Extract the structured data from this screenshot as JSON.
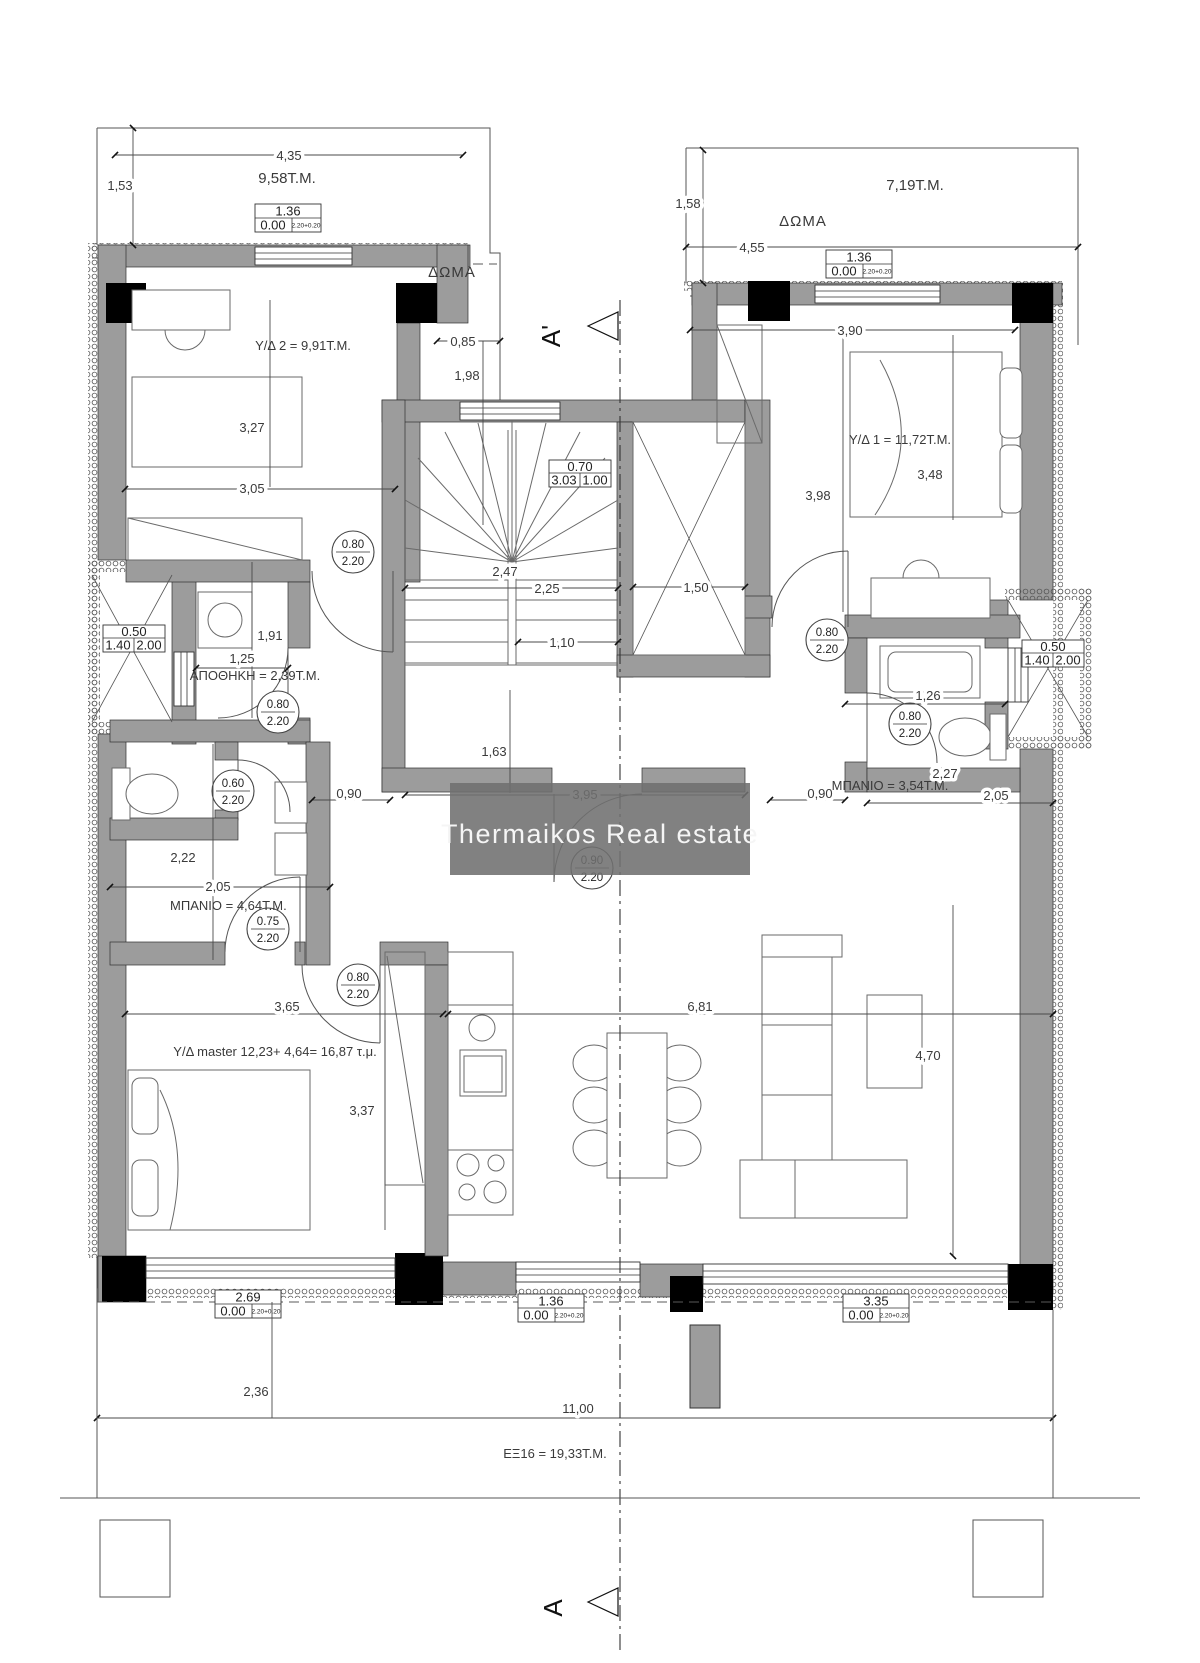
{
  "watermark": {
    "text": "Thermaikos Real estate",
    "bg_color": "#6f6f6f",
    "text_color": "#f5f5f5"
  },
  "rooms": {
    "bed2": "Υ/Δ 2 = 9,91Τ.Μ.",
    "bed1": "Υ/Δ 1 = 11,72Τ.Μ.",
    "master": "Υ/Δ master 12,23+ 4,64= 16,87 τ.μ.",
    "storage": "ΑΠΟΘΗΚΗ = 2,39Τ.Μ.",
    "bath_left": "ΜΠΑΝΙΟ = 4,64Τ.Μ.",
    "bath_right": "ΜΠΑΝΙΟ = 3,54Τ.Μ.",
    "balcony": "ΕΞ16 = 19,33Τ.Μ.",
    "roof_left": "ΔΩΜΑ",
    "roof_right": "ΔΩΜΑ",
    "roof_area_left": "9,58T.M.",
    "roof_area_right": "7,19T.M."
  },
  "sections": {
    "top": "A'",
    "bottom": "A"
  },
  "dims": {
    "d435": "4,35",
    "d153": "1,53",
    "d158": "1,58",
    "d455": "4,55",
    "d390": "3,90",
    "d327": "3,27",
    "d305": "3,05",
    "d085": "0,85",
    "d198": "1,98",
    "d247": "2,47",
    "d225": "2,25",
    "d110": "1,10",
    "d150": "1,50",
    "d191": "1,91",
    "d125": "1,25",
    "d163": "1,63",
    "d395": "3,95",
    "d090l": "0,90",
    "d090r": "0,90",
    "d126": "1,26",
    "d227": "2,27",
    "d205r": "2,05",
    "d222": "2,22",
    "d205l": "2,05",
    "d365": "3,65",
    "d337": "3,37",
    "d681": "6,81",
    "d470": "4,70",
    "d398": "3,98",
    "d348": "3,48",
    "d236": "2,36",
    "d1100": "11,00"
  },
  "door_tags": {
    "c1": {
      "w": "0.80",
      "h": "2.20"
    },
    "c2": {
      "w": "0.80",
      "h": "2.20"
    },
    "c3": {
      "w": "0.60",
      "h": "2.20"
    },
    "c4": {
      "w": "0.75",
      "h": "2.20"
    },
    "c5": {
      "w": "0.80",
      "h": "2.20"
    },
    "c6": {
      "w": "0.80",
      "h": "2.20"
    },
    "c7": {
      "w": "0.80",
      "h": "2.20"
    },
    "c8": {
      "w": "0.90",
      "h": "2.20"
    }
  },
  "window_tags": {
    "t1": {
      "a": "1.36",
      "b": "0.00",
      "c": "2.20+0.20"
    },
    "t2": {
      "a": "1.36",
      "b": "0.00",
      "c": "2.20+0.20"
    },
    "t3": {
      "a": "0.70",
      "b": "3.03",
      "c": "1.00"
    },
    "t4": {
      "a": "0.50",
      "b": "1.40",
      "c": "2.00"
    },
    "t5": {
      "a": "0.50",
      "b": "1.40",
      "c": "2.00"
    },
    "t6": {
      "a": "2.69",
      "b": "0.00",
      "c": "2.20+0.20"
    },
    "t7": {
      "a": "1.36",
      "b": "0.00",
      "c": "2.20+0.20"
    },
    "t8": {
      "a": "3.35",
      "b": "0.00",
      "c": "2.20+0.20"
    }
  }
}
